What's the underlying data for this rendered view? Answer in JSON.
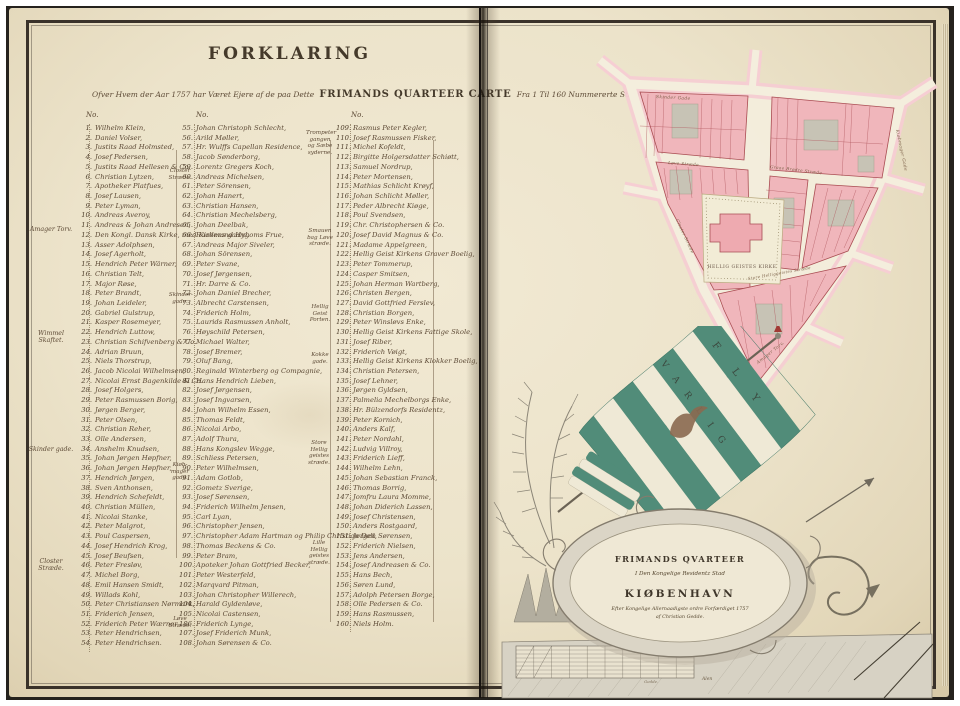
{
  "page": {
    "title": "FORKLARING"
  },
  "subtitle": {
    "lead": "Ofver Hvem der Aar 1757 har Været Ejere af de paa Dette",
    "emph": "FRIMANDS QUARTEER CARTE",
    "tail": "Fra 1 Til 160 Nummererte Stæder."
  },
  "legend": {
    "col_header": "No.",
    "margin1": [
      "Amager Torv.",
      "Wimmel Skaftet.",
      "Skinder gade.",
      "Closter Stræde."
    ],
    "margin2": [
      "Closter Stræde.",
      "Skinder gade.",
      "Kiøb- mager gade.",
      "Løve Stræde."
    ],
    "margin3": [
      "Trompeter gangen og Sæbe syderne.",
      "Smauen bag Løve stræde.",
      "Hellig Geist Porten.",
      "Kokke gade.",
      "Store Hellig geistes stræde.",
      "Lille Hellig geistes stræde."
    ],
    "columns": [
      {
        "entries": [
          {
            "n": "1.",
            "name": "Wilhelm Klein,"
          },
          {
            "n": "2.",
            "name": "Daniel Volser,"
          },
          {
            "n": "3.",
            "name": "Justits Raad Holmsted,"
          },
          {
            "n": "4.",
            "name": "Josef Pedersen,"
          },
          {
            "n": "5.",
            "name": "Justits Raad Hellesen & Co."
          },
          {
            "n": "6.",
            "name": "Christian Lytzen,"
          },
          {
            "n": "7.",
            "name": "Apotheker Platfues,"
          },
          {
            "n": "8.",
            "name": "Josef Lausen,"
          },
          {
            "n": "9.",
            "name": "Peter Lyman,"
          },
          {
            "n": "10.",
            "name": "Andreas Averoy,"
          },
          {
            "n": "11.",
            "name": "Andreas & Johan Andresen,"
          },
          {
            "n": "12.",
            "name": "Den Kongl. Dansk Kirke, med Kirkens gaard."
          },
          {
            "n": "13.",
            "name": "Asser Adolphsen,"
          },
          {
            "n": "14.",
            "name": "Josef Agerholt,"
          },
          {
            "n": "15.",
            "name": "Hendrich Peter Wärner,"
          },
          {
            "n": "16.",
            "name": "Christian Telt,"
          },
          {
            "n": "17.",
            "name": "Major Røse,"
          },
          {
            "n": "18.",
            "name": "Peter Brandt,"
          },
          {
            "n": "19.",
            "name": "Johan Leideler,"
          },
          {
            "n": "20.",
            "name": "Gabriel Gulstrup,"
          },
          {
            "n": "21.",
            "name": "Kasper Rosemeyer,"
          },
          {
            "n": "22.",
            "name": "Hendrich Luttow,"
          },
          {
            "n": "23.",
            "name": "Christian Schifvenberg & Co."
          },
          {
            "n": "24.",
            "name": "Adrian Bruun,"
          },
          {
            "n": "25.",
            "name": "Niels Thorstrup,"
          },
          {
            "n": "26.",
            "name": "Jacob Nicolai Wilhelmsen,"
          },
          {
            "n": "27.",
            "name": "Nicolai Ernst Bagenkilde & Co."
          },
          {
            "n": "28.",
            "name": "Josef Holgers,"
          },
          {
            "n": "29.",
            "name": "Peter Rasmussen Borig,"
          },
          {
            "n": "30.",
            "name": "Jørgen Berger,"
          },
          {
            "n": "31.",
            "name": "Peter Olsen,"
          },
          {
            "n": "32.",
            "name": "Christian Reher,"
          },
          {
            "n": "33.",
            "name": "Olle Andersen,"
          },
          {
            "n": "34.",
            "name": "Anshelm Knudsen,"
          },
          {
            "n": "35.",
            "name": "Johan Jørgen Høpfner,"
          },
          {
            "n": "36.",
            "name": "Johan Jørgen Høpfner,"
          },
          {
            "n": "37.",
            "name": "Hendrich Jørgen,"
          },
          {
            "n": "38.",
            "name": "Sven Anthonsen,"
          },
          {
            "n": "39.",
            "name": "Hendrich Schefeldt,"
          },
          {
            "n": "40.",
            "name": "Christian Müllen,"
          },
          {
            "n": "41.",
            "name": "Nicolai Stanke,"
          },
          {
            "n": "42.",
            "name": "Peter Malgrot,"
          },
          {
            "n": "43.",
            "name": "Poul Caspersen,"
          },
          {
            "n": "44.",
            "name": "Josef Hendrich Krog,"
          },
          {
            "n": "45.",
            "name": "Josef Beufsen,"
          },
          {
            "n": "46.",
            "name": "Peter Fresløv,"
          },
          {
            "n": "47.",
            "name": "Michel Borg,"
          },
          {
            "n": "48.",
            "name": "Emil Hansen Smidt,"
          },
          {
            "n": "49.",
            "name": "Willads Kohl,"
          },
          {
            "n": "50.",
            "name": "Peter Christiansen Nørmark,"
          },
          {
            "n": "51.",
            "name": "Friderich Jensen,"
          },
          {
            "n": "52.",
            "name": "Friderich Peter Wærner,"
          },
          {
            "n": "53.",
            "name": "Peter Hendrichsen,"
          },
          {
            "n": "54.",
            "name": "Peter Hendrichsen."
          }
        ]
      },
      {
        "entries": [
          {
            "n": "55.",
            "name": "Johan Christoph Schlecht,"
          },
          {
            "n": "56.",
            "name": "Arild Møller,"
          },
          {
            "n": "57.",
            "name": "Hr. Wulffs Capellan Residence,"
          },
          {
            "n": "58.",
            "name": "Jacob Sønderborg,"
          },
          {
            "n": "59.",
            "name": "Lorentz Gregers Koch,"
          },
          {
            "n": "60.",
            "name": "Andreas Michelsen,"
          },
          {
            "n": "61.",
            "name": "Peter Sörensen,"
          },
          {
            "n": "62.",
            "name": "Johan Hanert,"
          },
          {
            "n": "63.",
            "name": "Christian Hansen,"
          },
          {
            "n": "64.",
            "name": "Christian Mechelsberg,"
          },
          {
            "n": "65.",
            "name": "Johan Deelbak,"
          },
          {
            "n": "66.",
            "name": "Raadmand Hygoms Frue,"
          },
          {
            "n": "67.",
            "name": "Andreas Major Siveler,"
          },
          {
            "n": "68.",
            "name": "Johan Sörensen,"
          },
          {
            "n": "69.",
            "name": "Peter Svane,"
          },
          {
            "n": "70.",
            "name": "Josef Jørgensen,"
          },
          {
            "n": "71.",
            "name": "Hr. Darre & Co."
          },
          {
            "n": "72.",
            "name": "Johan Daniel Brecher,"
          },
          {
            "n": "73.",
            "name": "Albrecht Carstensen,"
          },
          {
            "n": "74.",
            "name": "Friderich Holm,"
          },
          {
            "n": "75.",
            "name": "Laurids Rasmussen Anholt,"
          },
          {
            "n": "76.",
            "name": "Høyschild Petersen,"
          },
          {
            "n": "77.",
            "name": "Michael Walter,"
          },
          {
            "n": "78.",
            "name": "Josef Bremer,"
          },
          {
            "n": "79.",
            "name": "Oluf Bang,"
          },
          {
            "n": "80.",
            "name": "Reginald Winterberg og Compagnie,"
          },
          {
            "n": "81.",
            "name": "Hans Hendrich Lieben,"
          },
          {
            "n": "82.",
            "name": "Josef Jørgensen,"
          },
          {
            "n": "83.",
            "name": "Josef Ingvarsen,"
          },
          {
            "n": "84.",
            "name": "Johan Wilhelm Essen,"
          },
          {
            "n": "85.",
            "name": "Thomas Feldt,"
          },
          {
            "n": "86.",
            "name": "Nicolai Arbo,"
          },
          {
            "n": "87.",
            "name": "Adolf Thura,"
          },
          {
            "n": "88.",
            "name": "Hans Kongslev Wegge,"
          },
          {
            "n": "89.",
            "name": "Schliess Petersen,"
          },
          {
            "n": "90.",
            "name": "Peter Wilhelmsen,"
          },
          {
            "n": "91.",
            "name": "Adam Gotlob,"
          },
          {
            "n": "92.",
            "name": "Gometz Sverige,"
          },
          {
            "n": "93.",
            "name": "Josef Sørensen,"
          },
          {
            "n": "94.",
            "name": "Friderich Wilhelm Jensen,"
          },
          {
            "n": "95.",
            "name": "Carl Lyan,"
          },
          {
            "n": "96.",
            "name": "Christopher Jensen,"
          },
          {
            "n": "97.",
            "name": "Christopher Adam Hartman og Philip Christian Dell,"
          },
          {
            "n": "98.",
            "name": "Thomas Beckens & Co."
          },
          {
            "n": "99.",
            "name": "Peter Bram,"
          },
          {
            "n": "100.",
            "name": "Apoteker Johan Gottfried Becker,"
          },
          {
            "n": "101.",
            "name": "Peter Westerfeld,"
          },
          {
            "n": "102.",
            "name": "Marqvard Pitman,"
          },
          {
            "n": "103.",
            "name": "Johan Christopher Willerech,"
          },
          {
            "n": "104.",
            "name": "Harald Gyldenløve,"
          },
          {
            "n": "105.",
            "name": "Nicolai Castensen,"
          },
          {
            "n": "106.",
            "name": "Friderich Lynge,"
          },
          {
            "n": "107.",
            "name": "Josef Friderich Munk,"
          },
          {
            "n": "108.",
            "name": "Johan Sørensen & Co."
          }
        ]
      },
      {
        "entries": [
          {
            "n": "109.",
            "name": "Rasmus Peter Kegler,"
          },
          {
            "n": "110.",
            "name": "Josef Rasmussen Fisker,"
          },
          {
            "n": "111.",
            "name": "Michel Kofeldt,"
          },
          {
            "n": "112.",
            "name": "Birgitte Holgersdatter Schiøtt,"
          },
          {
            "n": "113.",
            "name": "Samuel Nordrup,"
          },
          {
            "n": "114.",
            "name": "Peter Mortensen,"
          },
          {
            "n": "115.",
            "name": "Mathias Schlicht Krøyf,"
          },
          {
            "n": "116.",
            "name": "Johan Schlicht Møller,"
          },
          {
            "n": "117.",
            "name": "Peder Albrecht Kiøge,"
          },
          {
            "n": "118.",
            "name": "Poul Svendsen,"
          },
          {
            "n": "119.",
            "name": "Chr. Christophersen & Co."
          },
          {
            "n": "120.",
            "name": "Josef David Magnus & Co."
          },
          {
            "n": "121.",
            "name": "Madame Appelgreen,"
          },
          {
            "n": "122.",
            "name": "Hellig Geist Kirkens Graver Boelig,"
          },
          {
            "n": "123.",
            "name": "Peter Tommerup,"
          },
          {
            "n": "124.",
            "name": "Casper Smitsen,"
          },
          {
            "n": "125.",
            "name": "Johan Herman Wartberg,"
          },
          {
            "n": "126.",
            "name": "Christen Bergen,"
          },
          {
            "n": "127.",
            "name": "David Gottfried Ferslev,"
          },
          {
            "n": "128.",
            "name": "Christian Borgen,"
          },
          {
            "n": "129.",
            "name": "Peter Winsløvs Enke,"
          },
          {
            "n": "130.",
            "name": "Hellig Geist Kirkens Fattige Skole,"
          },
          {
            "n": "131.",
            "name": "Josef Riber,"
          },
          {
            "n": "132.",
            "name": "Friderich Vøigt,"
          },
          {
            "n": "133.",
            "name": "Hellig Geist Kirkens Klokker Boelig,"
          },
          {
            "n": "134.",
            "name": "Christian Petersen,"
          },
          {
            "n": "135.",
            "name": "Josef Lehner,"
          },
          {
            "n": "136.",
            "name": "Jørgen Gyldsen,"
          },
          {
            "n": "137.",
            "name": "Palmelia Mechelborgs Enke,"
          },
          {
            "n": "138.",
            "name": "Hr. Bülzendorfs Residentz,"
          },
          {
            "n": "139.",
            "name": "Peter Kornich,"
          },
          {
            "n": "140.",
            "name": "Anders Kalf,"
          },
          {
            "n": "141.",
            "name": "Peter Nordahl,"
          },
          {
            "n": "142.",
            "name": "Ludvig Villroy,"
          },
          {
            "n": "143.",
            "name": "Friderich Lieff,"
          },
          {
            "n": "144.",
            "name": "Wilhelm Lehn,"
          },
          {
            "n": "145.",
            "name": "Johan Sebastian Franck,"
          },
          {
            "n": "146.",
            "name": "Thomas Borrig,"
          },
          {
            "n": "147.",
            "name": "Jomfru Laura Momme,"
          },
          {
            "n": "148.",
            "name": "Johan Diderich Lassen,"
          },
          {
            "n": "149.",
            "name": "Josef Christensen,"
          },
          {
            "n": "150.",
            "name": "Anders Rostgaard,"
          },
          {
            "n": "151.",
            "name": "Jørgen Sørensen,"
          },
          {
            "n": "152.",
            "name": "Friderich Nielsen,"
          },
          {
            "n": "153.",
            "name": "Jens Andersen,"
          },
          {
            "n": "154.",
            "name": "Josef Andreasen & Co."
          },
          {
            "n": "155.",
            "name": "Hans Bech,"
          },
          {
            "n": "156.",
            "name": "Søren Lund,"
          },
          {
            "n": "157.",
            "name": "Adolph Petersen Borge,"
          },
          {
            "n": "158.",
            "name": "Olle Pedersen & Co."
          },
          {
            "n": "159.",
            "name": "Hans Rasmussen,"
          },
          {
            "n": "160.",
            "name": "Niels Holm."
          }
        ]
      }
    ]
  },
  "map": {
    "church_label": "Hellig Geistes Kirke",
    "streets": [
      "Skinder Gade",
      "Løve Stræde",
      "Graae Brødre Stræde",
      "Kiøbmager Gade",
      "Store Helliggeistes Stræde",
      "Closter Stræde",
      "Amager Torv."
    ],
    "colors": {
      "block": "#f0b6bb",
      "outline": "#aa4d53",
      "street": "#f4eedd",
      "halo": "#f6ced3",
      "court": "#c7c3b5",
      "yard": "#f2ecd6"
    }
  },
  "flag": {
    "motto_1": "FLY",
    "motto_2": "VARLIG"
  },
  "cartouche": {
    "title": "FRIMANDS QVARTEER",
    "line2": "I Den Kongelige Residentz Stad",
    "city": "KIØBENHAVN",
    "line3": "Efter Kongelige Allernaadigste ordre Forfærdiget 1757",
    "line4": "af Christian Gedde.",
    "scale_label": "Alen",
    "signature": "Gedde."
  }
}
